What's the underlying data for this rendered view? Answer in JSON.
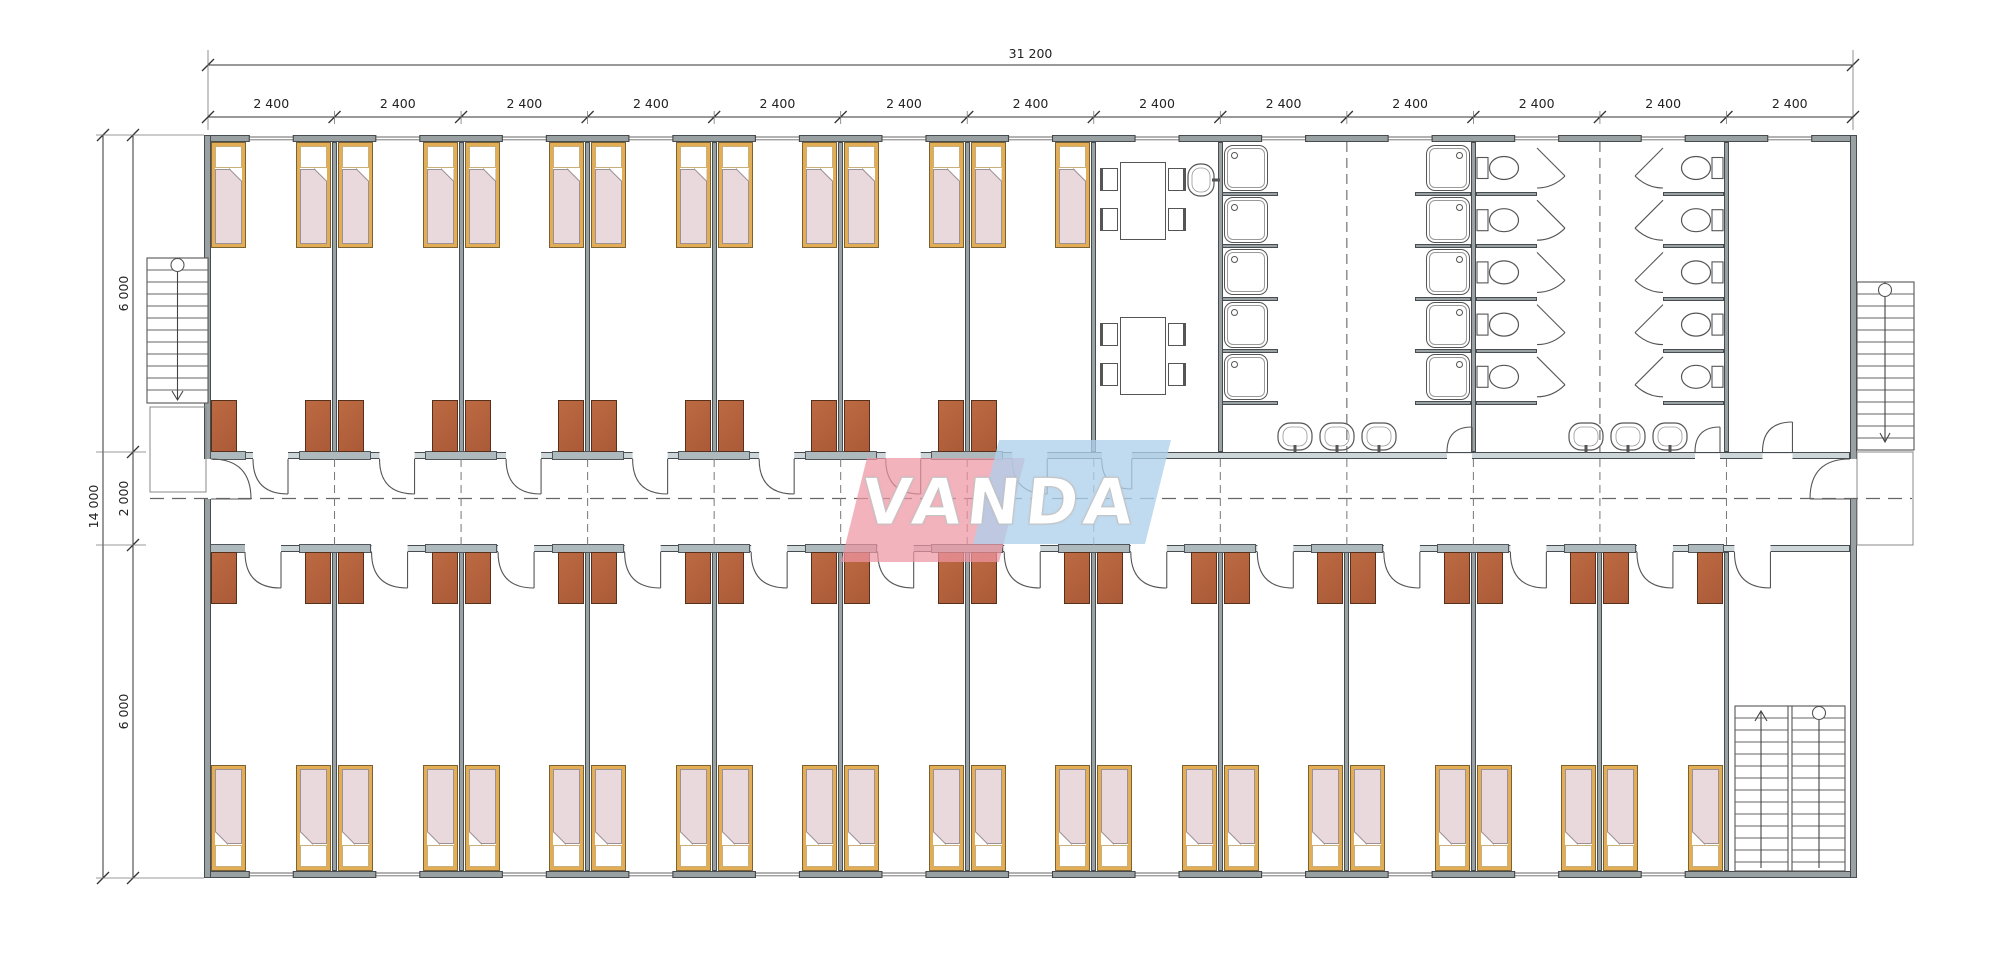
{
  "logo": {
    "text": "VANDA"
  },
  "dimensions": {
    "top_total_label": "31 200",
    "top_modules": [
      "2 400",
      "2 400",
      "2 400",
      "2 400",
      "2 400",
      "2 400",
      "2 400",
      "2 400",
      "2 400",
      "2 400",
      "2 400",
      "2 400",
      "2 400"
    ],
    "left_total_label": "14 000",
    "left_segments": [
      "6 000",
      "2 000",
      "6 000"
    ]
  },
  "plan": {
    "modules": 13,
    "top_bedrooms": 7,
    "bottom_bedrooms": 12,
    "beds": {
      "top": 14,
      "bottom": 24
    },
    "wardrobes": {
      "top": 13,
      "bottom": 24
    },
    "dining": {
      "tables": 2,
      "chairs": 8,
      "sinks": 1
    },
    "washroom": {
      "showers": 10,
      "wash_basins": 6
    },
    "toilet_stalls": 10,
    "stairs": {
      "exterior": 2,
      "interior": 1
    },
    "colors": {
      "wall": "#9aa1a3",
      "wall_edge": "#464c50",
      "corridor_wall": "#ccd5d7",
      "sill": "#aeb9be",
      "bed_frame": "#e2ad55",
      "bed_frame_edge": "#7a6232",
      "blanket": "#e9d8dc",
      "blanket_edge": "#9b9093",
      "wardrobe": "#ab5a38",
      "wardrobe_edge": "#57301b",
      "fixture_line": "#555555",
      "dim_line": "#333333",
      "dash_line": "#666666",
      "logo_pink": "#ef96a3",
      "logo_blue": "#aecfeb"
    }
  }
}
